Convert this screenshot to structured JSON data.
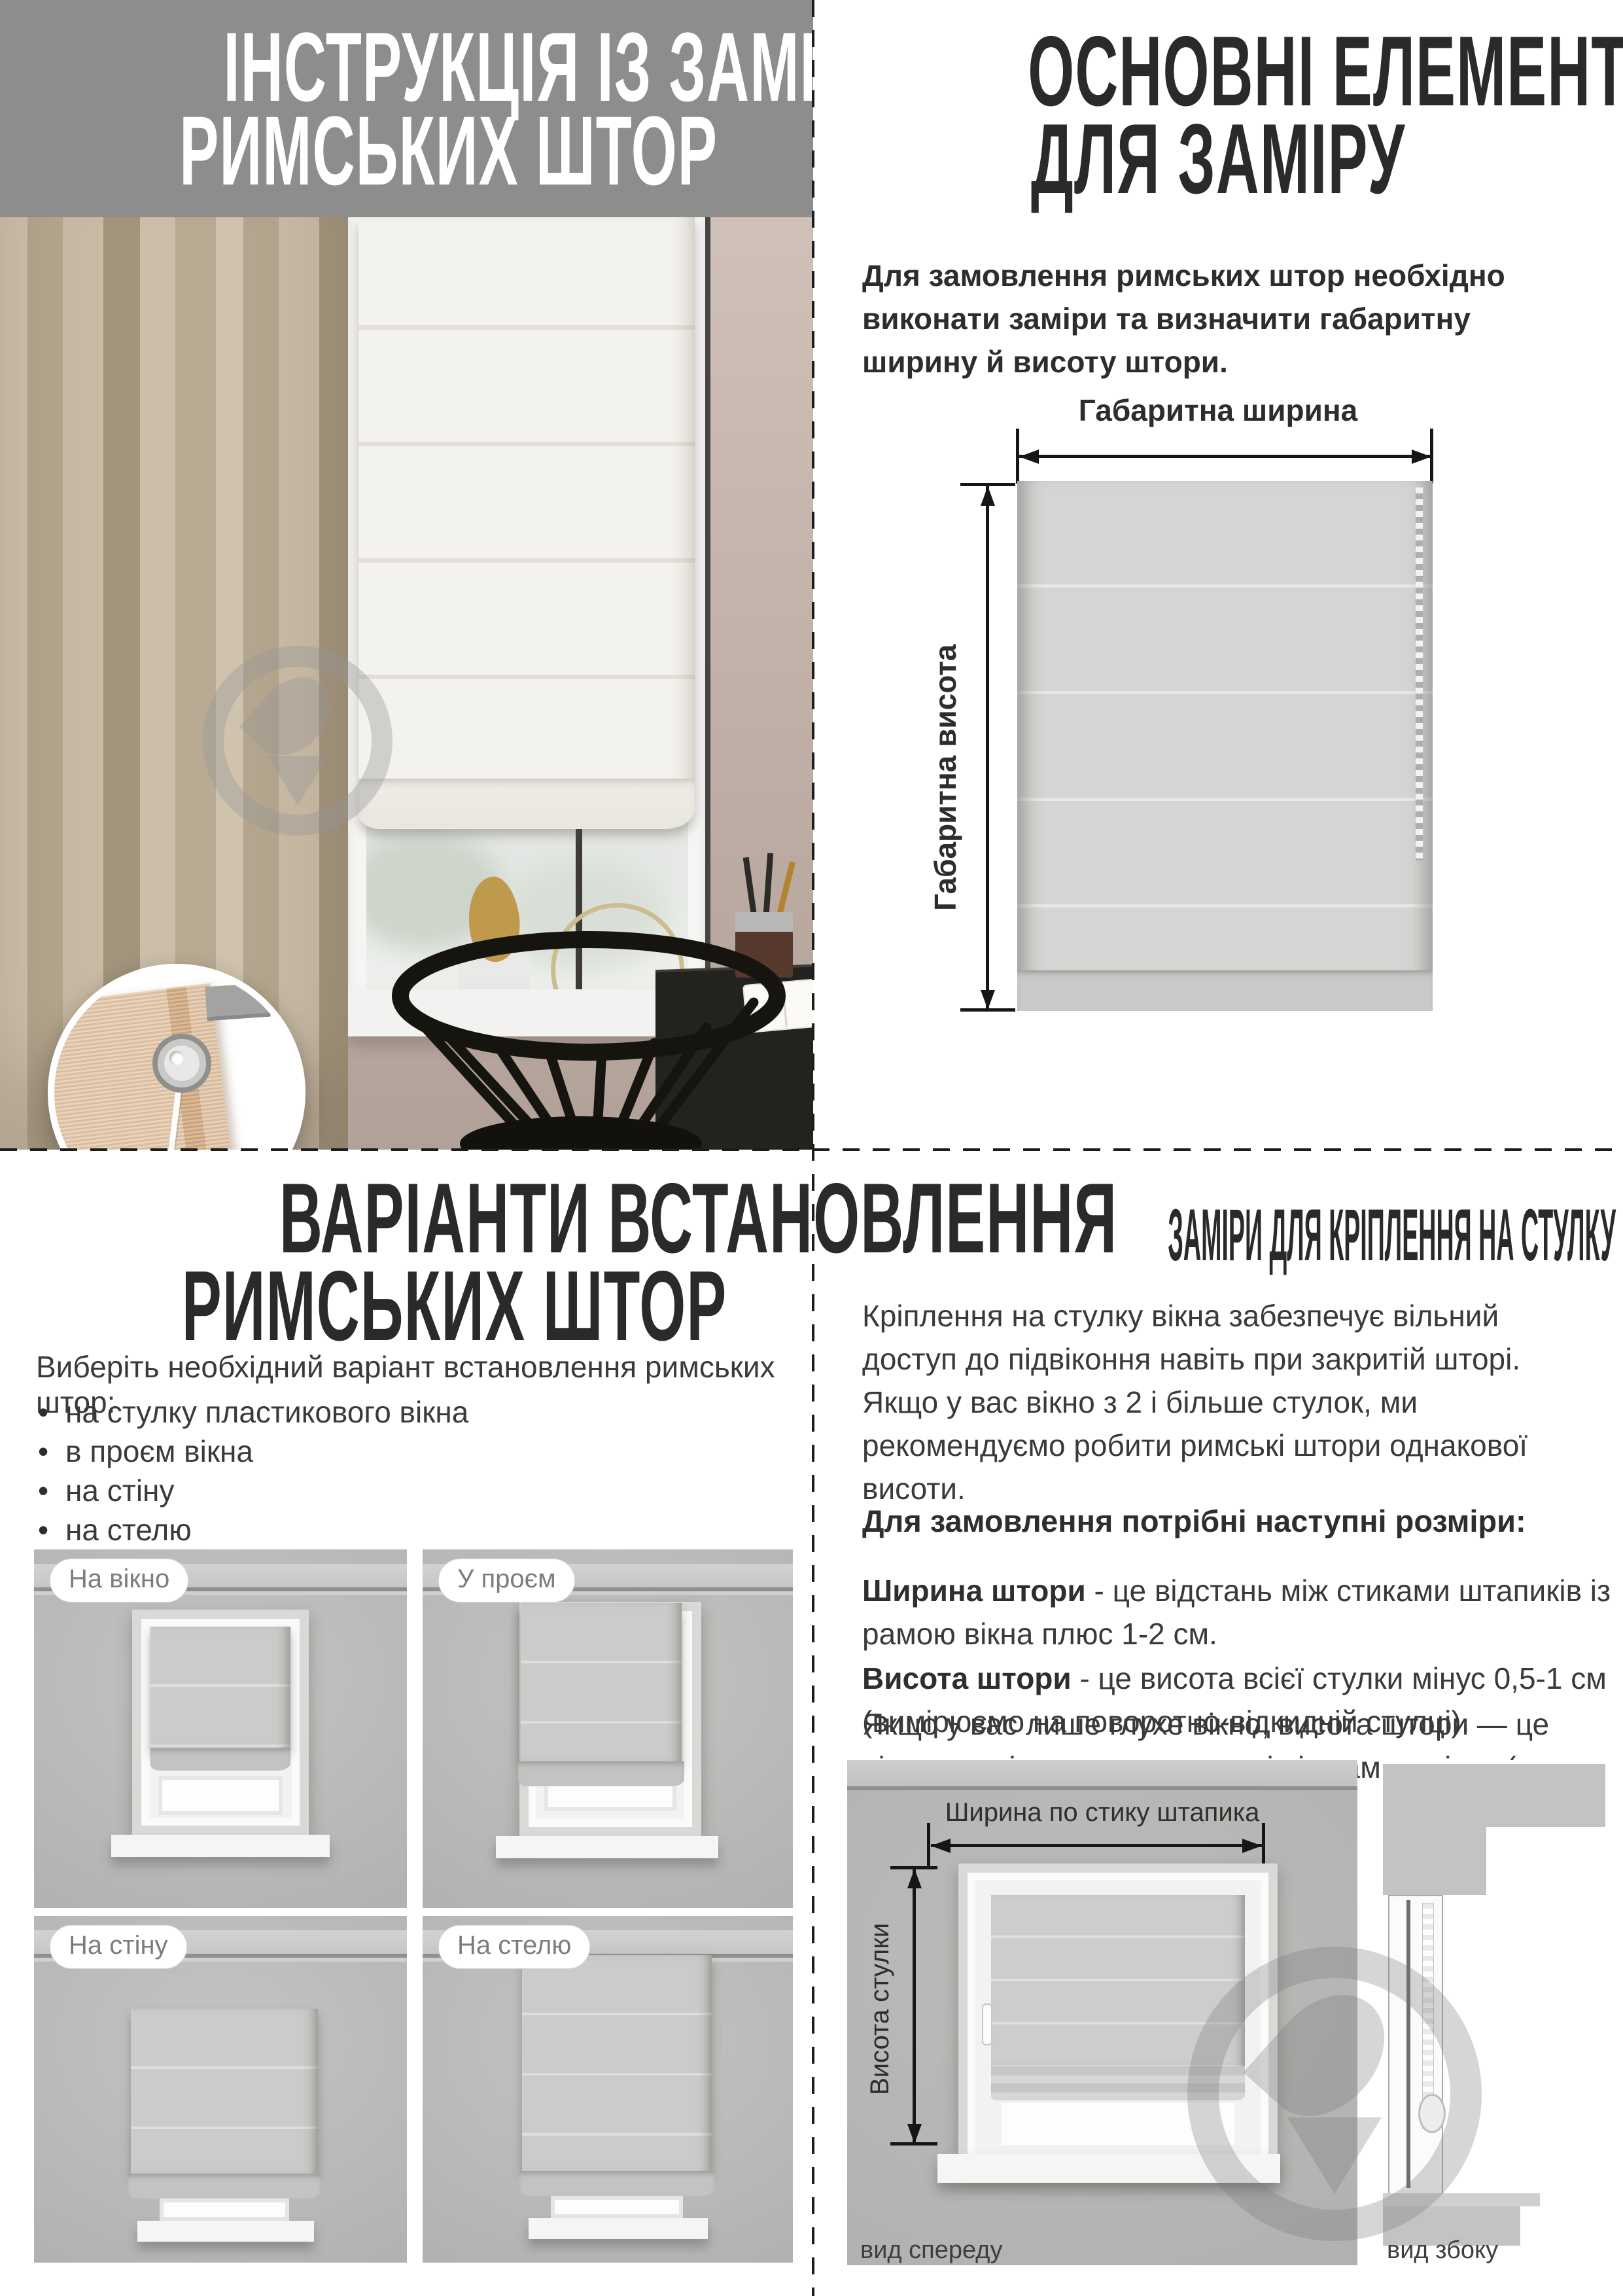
{
  "top_left": {
    "header_title_line1": "ІНСТРУКЦІЯ ІЗ ЗАМІРУ",
    "header_title_line2": "РИМСЬКИХ ШТОР"
  },
  "top_right": {
    "title_line1": "ОСНОВНІ ЕЛЕМЕНТИ",
    "title_line2": "ДЛЯ ЗАМІРУ",
    "intro": "Для замовлення римських штор необхідно виконати заміри та визначити габаритну ширину й висоту штори.",
    "diagram": {
      "width_label": "Габаритна ширина",
      "height_label": "Габаритна висота"
    }
  },
  "bottom_left": {
    "title_line1": "ВАРІАНТИ ВСТАНОВЛЕННЯ",
    "title_line2": "РИМСЬКИХ ШТОР",
    "intro": "Виберіть необхідний варіант встановлення римських штор:",
    "bullets": [
      "на стулку пластикового вікна",
      "в проєм вікна",
      "на стіну",
      "на стелю"
    ],
    "variants": [
      {
        "label": "На вікно"
      },
      {
        "label": "У проєм"
      },
      {
        "label": "На стіну"
      },
      {
        "label": "На стелю"
      }
    ]
  },
  "bottom_right": {
    "title": "ЗАМІРИ ДЛЯ КРІПЛЕННЯ НА СТУЛКУ ВІКНА",
    "paragraph1": "Кріплення на стулку вікна забезпечує вільний доступ до підвіконня навіть при закритій шторі. Якщо у вас вікно з 2 і більше стулок, ми рекомендуємо робити римські штори однакової висоти.",
    "sizes_heading": "Для замовлення потрібні наступні розміри:",
    "width_term": "Ширина штори",
    "width_def": "- це відстань між стиками штапиків із рамою вікна плюс 1-2 см.",
    "height_term": "Висота штори",
    "height_def": "- це висота всієї стулки мінус 0,5-1 см (вимірюємо на поворотно-відкидній стулці).",
    "paragraph2": "Якщо у вас лише глухе вікно, висота штори — це відстань між стиками штапиків із рамою вікна (плюс 1-3 см).",
    "front_view": {
      "width_label": "Ширина по стику штапика",
      "height_label": "Висота стулки",
      "caption": "вид спереду"
    },
    "side_view": {
      "caption": "вид збоку"
    }
  },
  "colors": {
    "header_gray": "#8d8d8c",
    "title_black": "#2b2a28",
    "body_gray": "#3b3a38"
  }
}
